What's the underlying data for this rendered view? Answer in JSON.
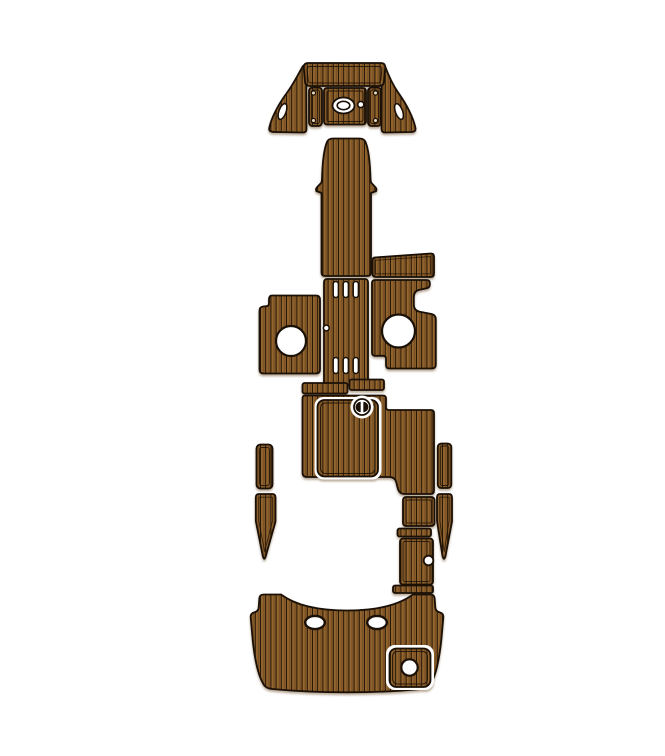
{
  "image": {
    "type": "product-illustration",
    "background": "#ffffff",
    "description": "EVA foam faux teak boat deck pad set shown as a top-view template layout of separate plank-textured pieces"
  },
  "palette": {
    "plank": "#8c5e2b",
    "plank_seam": "#241505",
    "plank_highlight": "#9d6d33",
    "plank_shade": "#5f3f18",
    "outline": "#1a1006",
    "gap": "#ffffff",
    "cutout": "#ffffff",
    "screw": "#e7d9bd"
  },
  "pieces": {
    "bow_wing_left": {
      "label": "Bow side wing pad (left) with slot cutout"
    },
    "bow_wing_right": {
      "label": "Bow side wing pad (right) with slot cutout"
    },
    "bow_top_band": {
      "label": "Bow top arch pad"
    },
    "bow_strip_left": {
      "label": "Bow narrow strip (left) with two screw marks"
    },
    "bow_strip_right": {
      "label": "Bow narrow strip (right) with two screw marks"
    },
    "bow_hatch": {
      "label": "Bow hatch pad with oval anchor cutout and small round cutout"
    },
    "bow_walkway": {
      "label": "Bow walkway pad"
    },
    "side_band": {
      "label": "Starboard step band pad"
    },
    "center_column": {
      "label": "Cockpit center column pad with six vent slots and side hole"
    },
    "cockpit_pad_left": {
      "label": "Cockpit pad (left) with round speaker cutout"
    },
    "cockpit_pad_right": {
      "label": "Cockpit pad (right) with round speaker cutout"
    },
    "seat_bar_left": {
      "label": "Seat base bar (left)"
    },
    "seat_bar_right": {
      "label": "Seat base bar (right)"
    },
    "mid_deck": {
      "label": "Mid deck pad with inset engine hatch panel and round latch cutout"
    },
    "step_strip_left": {
      "label": "Gunwale strip (left)"
    },
    "dagger_left": {
      "label": "Pointed trim strip (left)"
    },
    "step_strip_right": {
      "label": "Gunwale strip (right)"
    },
    "dagger_right": {
      "label": "Pointed trim strip (right)"
    },
    "stern_square": {
      "label": "Stern step square pad"
    },
    "stern_bar_upper": {
      "label": "Stern thin tread (upper)"
    },
    "stern_gate": {
      "label": "Transom gate pad with round cutout"
    },
    "stern_bar_lower": {
      "label": "Stern thin tread (lower)"
    },
    "swim_platform": {
      "label": "Swim platform pad with two cleat cutouts and inset corner panel"
    }
  }
}
